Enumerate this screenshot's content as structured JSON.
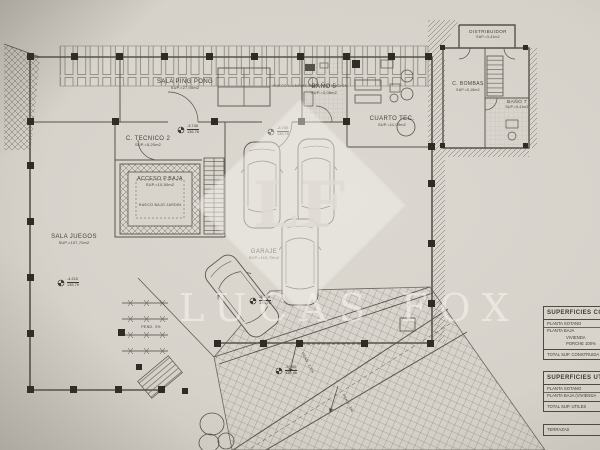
{
  "notes": {
    "top_strip": "HUECO ILUMINACION Y VENTILACION",
    "hueco_bajo_jardin": "HUECO BAJO JARDIN"
  },
  "rooms": {
    "sala_ping_pong": {
      "name": "SALA PING PONG",
      "area": "SUP.=27,00m2"
    },
    "bano_5": {
      "name": "BAÑO 5",
      "area": "SUP.=3,08m2"
    },
    "cuarto_tec": {
      "name": "CUARTO TEC.",
      "area": "SUP.=11,09m2"
    },
    "c_tecnico_2": {
      "name": "C. TECNICO 2",
      "area": "SUP.=5,20m2"
    },
    "acceso_pbaja": {
      "name": "ACCESO P.BAJA",
      "area": "SUP.=10,50m2"
    },
    "sala_juegos": {
      "name": "SALA JUEGOS",
      "area": "SUP.=107,70m2"
    },
    "garaje": {
      "name": "GARAJE",
      "area": "SUP.=115,79m2"
    },
    "distribuidor": {
      "name": "DISTRIBUIDOR",
      "area": "SUP.=3,41m2"
    },
    "c_bombas": {
      "name": "C. BOMBAS",
      "area": "SUP.=5,18m2"
    },
    "bano_7": {
      "name": "BAÑO 7",
      "area": "SUP.=5,41m2"
    }
  },
  "levels": {
    "m1": {
      "value": "-3.740",
      "cota": "136.76"
    },
    "m2": {
      "value": "-3.740",
      "cota": "136.76"
    },
    "m3": {
      "value": "-4.210",
      "cota": "135.79"
    },
    "m4": {
      "value": "-3.740",
      "cota": "136.76"
    },
    "m5": {
      "value": "-3.950",
      "cota": "136.46"
    }
  },
  "slopes": {
    "fence": "PEND. 3%",
    "ramp_upper": "PEND. 3,5%",
    "ramp_lower": "PEND. 3%"
  },
  "watermark": {
    "monogram": "LF",
    "brand": "LUCAS FOX"
  },
  "tables": {
    "construidas": {
      "title": "SUPERFICIES CONSTRUIDAS",
      "rows": [
        "PLANTA SOTANO",
        "PLANTA BAJA",
        "VIVIENDA",
        "PORCHE 100%"
      ],
      "total": "TOTAL SUP. CONSTRUIDA"
    },
    "utiles": {
      "title": "SUPERFICIES UTILES",
      "rows": [
        "PLANTA SOTANO",
        "PLANTA BAJA (VIVIENDA"
      ],
      "total": "TOTAL SUP. UTILES",
      "extra": "TERRAZAS"
    }
  }
}
